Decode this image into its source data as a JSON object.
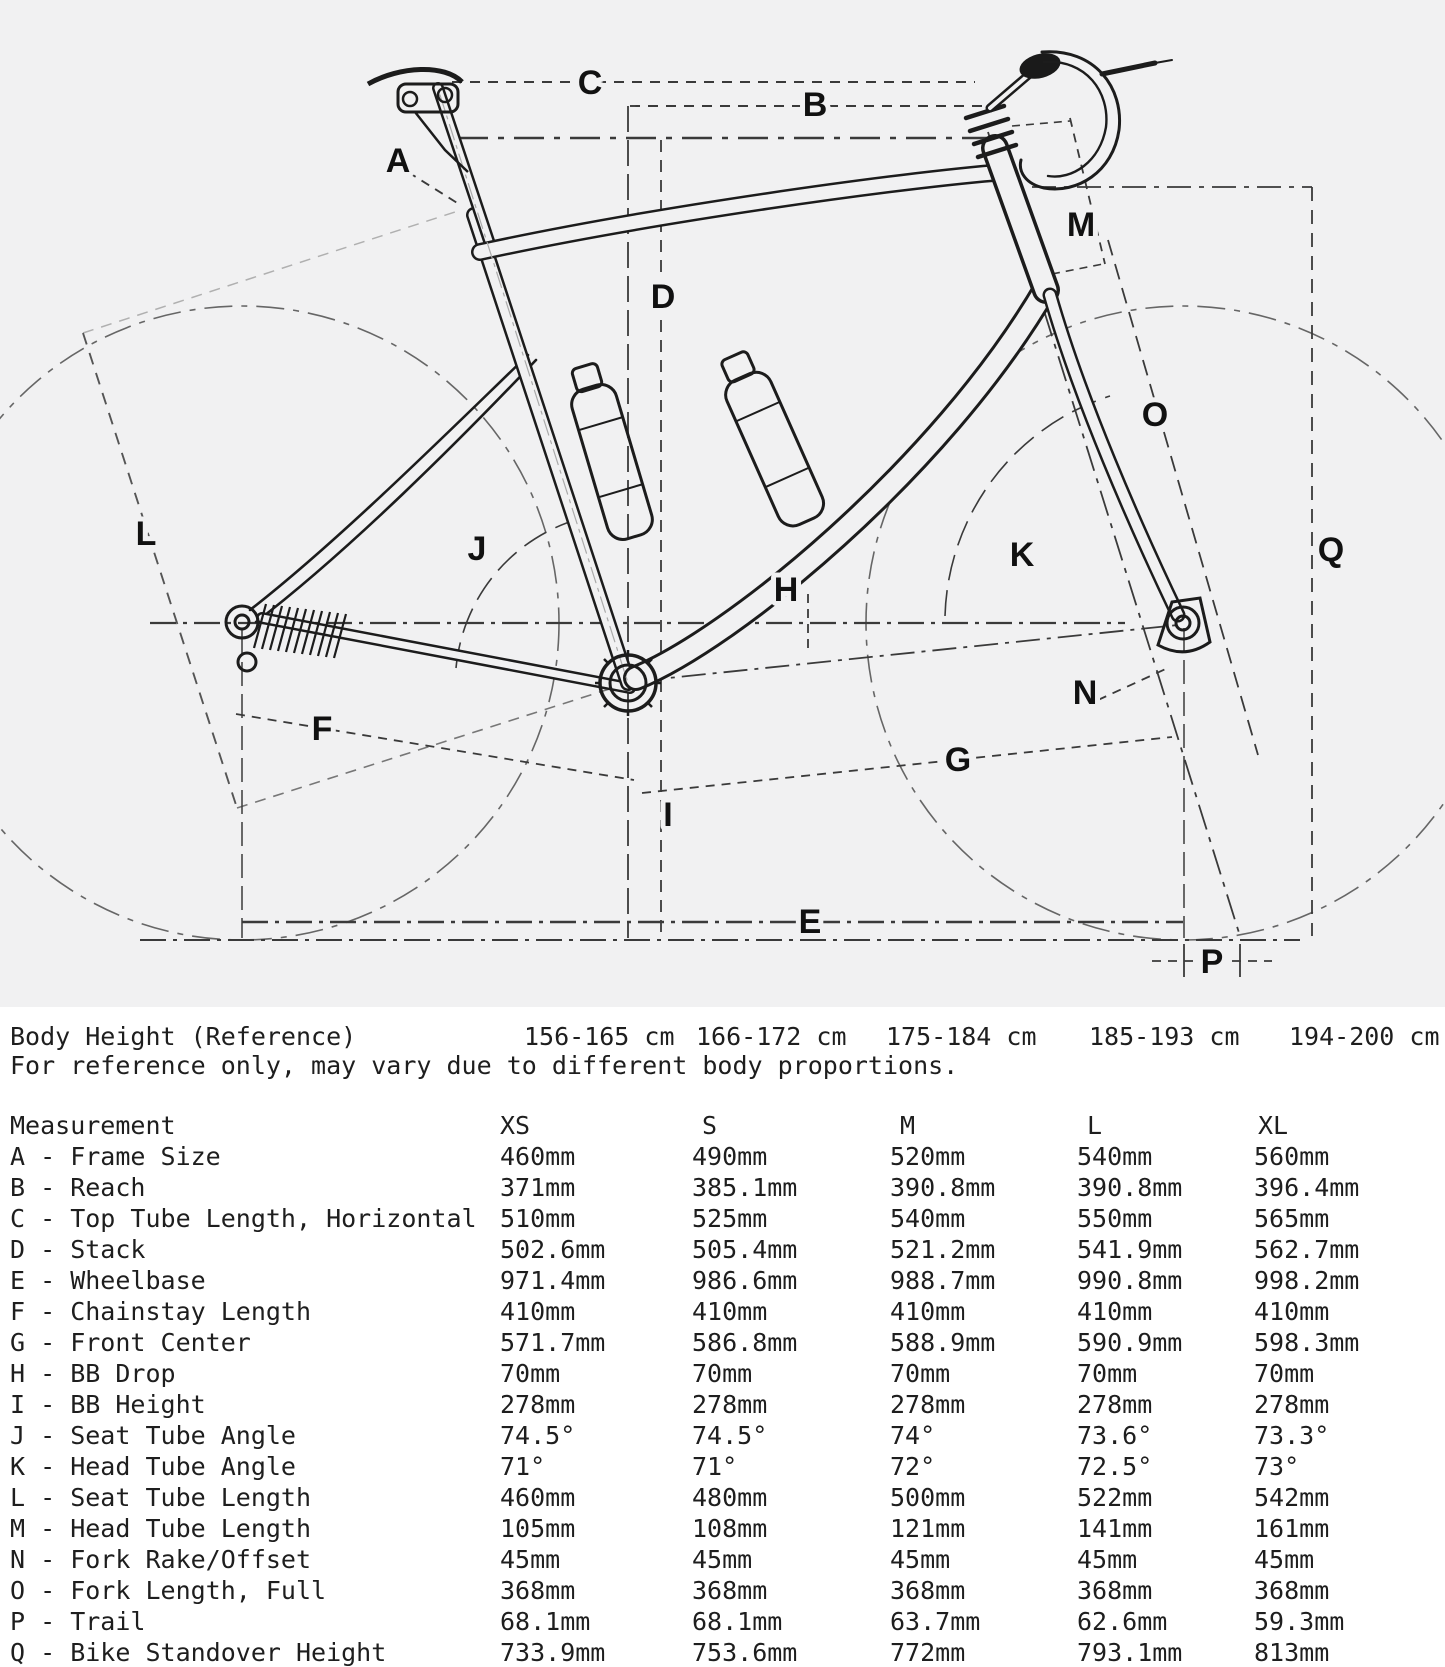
{
  "diagram": {
    "labels": [
      "A",
      "B",
      "C",
      "D",
      "E",
      "F",
      "G",
      "H",
      "I",
      "J",
      "K",
      "L",
      "M",
      "N",
      "O",
      "P",
      "Q"
    ],
    "background_color": "#f1f1f2",
    "line_color": "#1c1c1c",
    "dash_color": "#3a3a3a"
  },
  "body_height": {
    "label": "Body Height (Reference)",
    "values": [
      "156-165 cm",
      "166-172 cm",
      "175-184 cm",
      "185-193 cm",
      "194-200 cm"
    ],
    "note": "For reference only, may vary due to different body proportions."
  },
  "table": {
    "header": [
      "Measurement",
      "XS",
      "S",
      "M",
      "L",
      "XL"
    ],
    "rows": [
      {
        "label": "A - Frame Size",
        "values": [
          "460mm",
          "490mm",
          "520mm",
          "540mm",
          "560mm"
        ]
      },
      {
        "label": "B - Reach",
        "values": [
          "371mm",
          "385.1mm",
          "390.8mm",
          "390.8mm",
          "396.4mm"
        ]
      },
      {
        "label": "C - Top Tube Length, Horizontal",
        "values": [
          "510mm",
          "525mm",
          "540mm",
          "550mm",
          "565mm"
        ]
      },
      {
        "label": "D - Stack",
        "values": [
          "502.6mm",
          "505.4mm",
          "521.2mm",
          "541.9mm",
          "562.7mm"
        ]
      },
      {
        "label": "E - Wheelbase",
        "values": [
          "971.4mm",
          "986.6mm",
          "988.7mm",
          "990.8mm",
          "998.2mm"
        ]
      },
      {
        "label": "F - Chainstay Length",
        "values": [
          "410mm",
          "410mm",
          "410mm",
          "410mm",
          "410mm"
        ]
      },
      {
        "label": "G - Front Center",
        "values": [
          "571.7mm",
          "586.8mm",
          "588.9mm",
          "590.9mm",
          "598.3mm"
        ]
      },
      {
        "label": "H - BB Drop",
        "values": [
          "70mm",
          "70mm",
          "70mm",
          "70mm",
          "70mm"
        ]
      },
      {
        "label": "I - BB Height",
        "values": [
          "278mm",
          "278mm",
          "278mm",
          "278mm",
          "278mm"
        ]
      },
      {
        "label": "J - Seat Tube Angle",
        "values": [
          "74.5°",
          "74.5°",
          "74°",
          "73.6°",
          "73.3°"
        ]
      },
      {
        "label": "K - Head Tube Angle",
        "values": [
          "71°",
          "71°",
          "72°",
          "72.5°",
          "73°"
        ]
      },
      {
        "label": "L - Seat Tube Length",
        "values": [
          "460mm",
          "480mm",
          "500mm",
          "522mm",
          "542mm"
        ]
      },
      {
        "label": "M - Head Tube Length",
        "values": [
          "105mm",
          "108mm",
          "121mm",
          "141mm",
          "161mm"
        ]
      },
      {
        "label": "N - Fork Rake/Offset",
        "values": [
          "45mm",
          "45mm",
          "45mm",
          "45mm",
          "45mm"
        ]
      },
      {
        "label": "O - Fork Length, Full",
        "values": [
          "368mm",
          "368mm",
          "368mm",
          "368mm",
          "368mm"
        ]
      },
      {
        "label": "P - Trail",
        "values": [
          "68.1mm",
          "68.1mm",
          "63.7mm",
          "62.6mm",
          "59.3mm"
        ]
      },
      {
        "label": "Q - Bike Standover Height",
        "values": [
          "733.9mm",
          "753.6mm",
          "772mm",
          "793.1mm",
          "813mm"
        ]
      }
    ]
  }
}
